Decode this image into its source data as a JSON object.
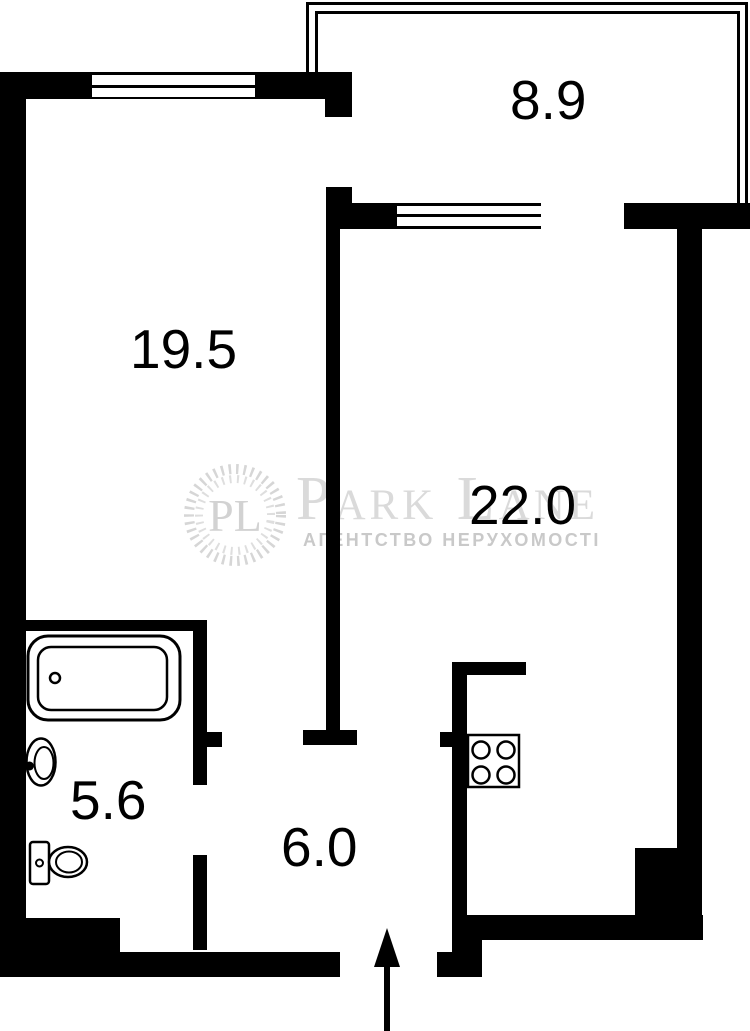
{
  "plan_title": "Apartment floor plan",
  "rooms": [
    {
      "id": "balcony",
      "area": "8.9"
    },
    {
      "id": "living-room",
      "area": "19.5"
    },
    {
      "id": "main-room",
      "area": "22.0"
    },
    {
      "id": "bathroom",
      "area": "5.6"
    },
    {
      "id": "hallway",
      "area": "6.0"
    }
  ],
  "watermark": {
    "logo_initials": "PL",
    "brand": "Park Lane",
    "tagline": "АГЕНТСТВО НЕРУХОМОСТІ"
  },
  "colors": {
    "wall": "#000000",
    "background": "#ffffff",
    "watermark_brand": "#dadada",
    "watermark_tagline": "#c9c9c9"
  },
  "fixtures": [
    "bathtub-icon",
    "sink-icon",
    "toilet-icon",
    "stove-icon",
    "entrance-arrow-icon",
    "window-icon",
    "balcony-railing-icon"
  ]
}
